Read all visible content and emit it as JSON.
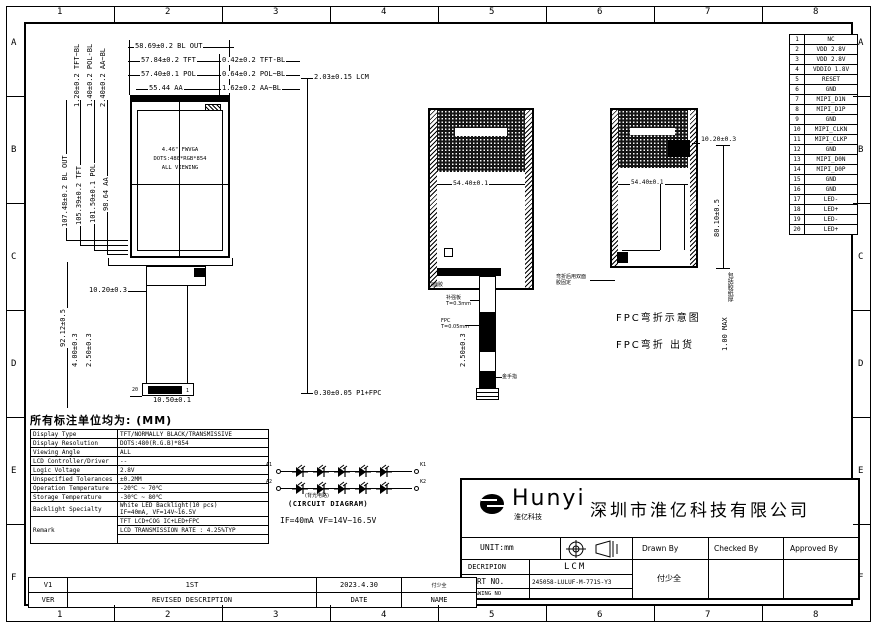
{
  "sheet": {
    "unit_note": "所有标注单位均为: (MM)"
  },
  "border_refs": {
    "cols": [
      "1",
      "2",
      "3",
      "4",
      "5",
      "6",
      "7",
      "8"
    ],
    "rows": [
      "A",
      "B",
      "C",
      "D",
      "E",
      "F"
    ]
  },
  "front_view": {
    "dim_bl_out_w": "58.69±0.2 BL OUT",
    "dim_tft_w": "57.84±0.2 TFT",
    "dim_tft_bl": "0.42±0.2 TFT-BL",
    "dim_pol_w": "57.40±0.1 POL",
    "dim_pol_bl": "0.64±0.2 POL~BL",
    "dim_aa_w": "55.44 AA",
    "dim_aa_bl": "1.62±0.2 AA~BL",
    "dim_tft_bl_v": "1.20±0.2 TFT~BL",
    "dim_pol_bl_v": "1.40±0.2 POL-BL",
    "dim_aa_bl_v": "2.40±0.2 AA~BL",
    "dim_bl_out_h": "107.48±0.2 BL OUT",
    "dim_tft_h": "105.39±0.2 TFT",
    "dim_pol_h": "101.50±0.1 POL",
    "dim_aa_h": "98.64 AA",
    "dim_fpc_len": "92.12±0.5",
    "screen_line1": "4.46\" FWVGA",
    "screen_line2": "DOTS:480*RGB*854",
    "screen_line3": "ALL VIEWING",
    "dim_fpc_top": "10.20±0.3",
    "dim_conn_h1": "4.00±0.3",
    "dim_conn_h2": "2.50±0.3",
    "dim_conn_w": "10.50±0.1",
    "pin20": "20",
    "pin1": "1"
  },
  "side_view": {
    "dim_top": "2.03±0.15  LCM",
    "dim_bottom": "0.30±0.05 P1+FPC"
  },
  "back_view": {
    "dim_tape_w": "54.40±0.1",
    "label_tape": "双面胶",
    "label_stiffener": "补强板\nT=0.3mm",
    "label_fpc_t": "FPC\nT=0.05mm",
    "dim_fold": "2.50±0.3",
    "label_gold": "金手指"
  },
  "folded_view": {
    "title": "FPC弯折示意图",
    "subtitle": "FPC弯折 出货",
    "dim_top": "10.20±0.3",
    "dim_h": "80.10±0.5",
    "dim_tape_w": "54.40±0.1",
    "note": "弯折后用双面胶固定",
    "side_note": "包括胶纸厚",
    "side_note2": "1.00 MAX"
  },
  "pin_table": {
    "pins": [
      {
        "no": "1",
        "name": "NC"
      },
      {
        "no": "2",
        "name": "VDD 2.8V"
      },
      {
        "no": "3",
        "name": "VDD 2.8V"
      },
      {
        "no": "4",
        "name": "VDDIO 1.8V"
      },
      {
        "no": "5",
        "name": "RESET"
      },
      {
        "no": "6",
        "name": "GND"
      },
      {
        "no": "7",
        "name": "MIPI_D1N"
      },
      {
        "no": "8",
        "name": "MIPI_D1P"
      },
      {
        "no": "9",
        "name": "GND"
      },
      {
        "no": "10",
        "name": "MIPI_CLKN"
      },
      {
        "no": "11",
        "name": "MIPI_CLKP"
      },
      {
        "no": "12",
        "name": "GND"
      },
      {
        "no": "13",
        "name": "MIPI_D0N"
      },
      {
        "no": "14",
        "name": "MIPI_D0P"
      },
      {
        "no": "15",
        "name": "GND"
      },
      {
        "no": "16",
        "name": "GND"
      },
      {
        "no": "17",
        "name": "LED-"
      },
      {
        "no": "18",
        "name": "LED+"
      },
      {
        "no": "19",
        "name": "LED-"
      },
      {
        "no": "20",
        "name": "LED+"
      }
    ]
  },
  "spec_table": {
    "rows": [
      {
        "label": "Display Type",
        "values": [
          "TFT/NORMALLY BLACK/TRANSMISSIVE"
        ]
      },
      {
        "label": "Display Resolution",
        "values": [
          "DOTS:480(R.G.B)*854"
        ]
      },
      {
        "label": "Viewing Angle",
        "values": [
          "ALL"
        ]
      },
      {
        "label": "LCD Controller/Driver",
        "values": [
          "--"
        ]
      },
      {
        "label": "Logic Voltage",
        "values": [
          "2.8V"
        ]
      },
      {
        "label": "Unspecified Tolerances",
        "values": [
          "±0.2MM"
        ]
      },
      {
        "label": "Operation Temperature",
        "values": [
          "-20℃ ~ 70℃"
        ]
      },
      {
        "label": "Storage Temperature",
        "values": [
          "-30℃ ~ 80℃"
        ]
      },
      {
        "label": "Backlight Specialty",
        "values": [
          "White LED Backlight(10 pcs)\nIF=40mA, VF=14V~16.5V"
        ]
      },
      {
        "label": "Remark",
        "values": [
          "TFT LCD+COG IC+LED+FPC",
          "LCD TRANSMISSION RATE : 4.25%TYP",
          ""
        ]
      }
    ]
  },
  "circuit": {
    "label_cn": "(背光电路)",
    "label_en": "(CIRCUIT DIAGRAM)",
    "spec": "IF=40mA  VF=14V~16.5V",
    "t_a1": "A1",
    "t_a2": "A2",
    "t_k1": "K1",
    "t_k2": "K2",
    "leds_per_row": 5,
    "rows": 2
  },
  "title_block": {
    "logo_text": "Hunyi",
    "logo_sub": "淮亿科技",
    "company": "深圳市淮亿科技有限公司",
    "unit": "UNIT:mm",
    "drawn_by": "Drawn By",
    "checked_by": "Checked By",
    "approved_by": "Approved By",
    "desc_label": "DECRIPION",
    "desc_value": "LCM",
    "part_label": "PART NO.",
    "part_value": "245058-LULUF-M-771S-Y3",
    "drawing_label": "DRAWING NO",
    "drawn_sig": "付少全"
  },
  "revision_table": {
    "ver_value": "V1",
    "desc_value": "1ST",
    "date_value": "2023.4.30",
    "name_value": "付少全",
    "ver_label": "VER",
    "desc_label": "REVISED DESCRIPTION",
    "date_label": "DATE",
    "name_label": "NAME"
  }
}
